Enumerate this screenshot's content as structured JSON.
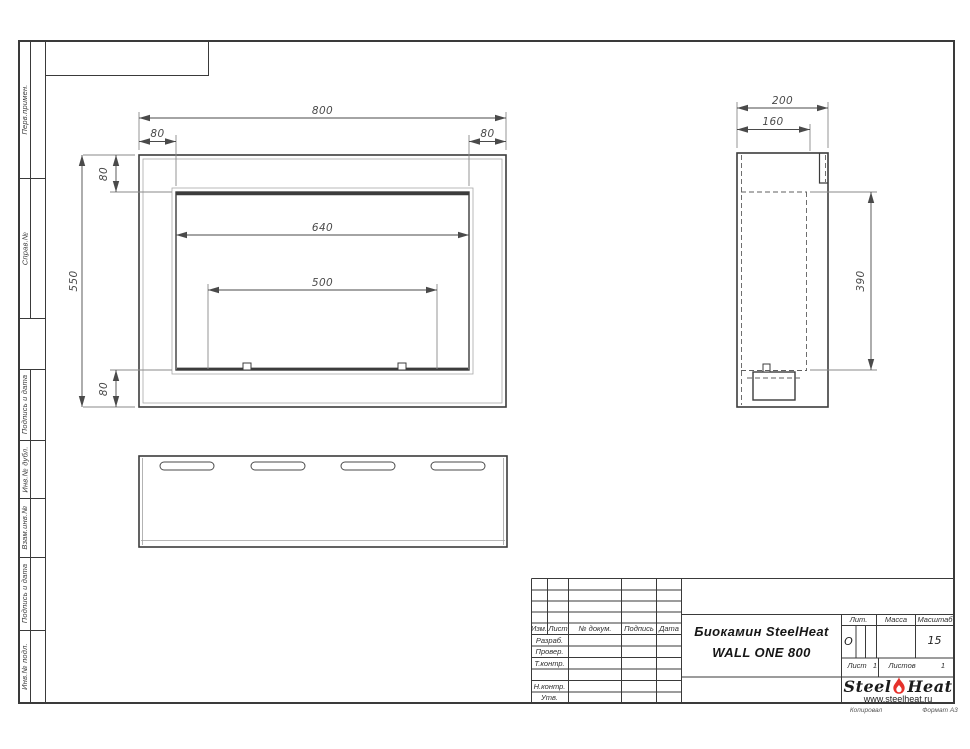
{
  "sheet": {
    "kopiroval_label": "Копировал",
    "format_label": "Формат А3"
  },
  "sidebar": {
    "labels": [
      "Перв.примен.",
      "Справ.№",
      "Подпись и дата",
      "Инв.№ дубл.",
      "Взам.инв.№",
      "Подпись и дата",
      "Инв.№ подл."
    ]
  },
  "drawing": {
    "dims": {
      "front": {
        "width": "800",
        "left": "80",
        "right": "80",
        "opening": "640",
        "burner": "500",
        "height": "550",
        "top": "80",
        "bottom": "80"
      },
      "side": {
        "depth": "200",
        "inner_depth": "160",
        "opening_height": "390"
      }
    }
  },
  "title_block": {
    "col_headers": [
      "Изм.",
      "Лист",
      "№ докум.",
      "Подпись",
      "Дата"
    ],
    "row_labels": [
      "Разраб.",
      "Провер.",
      "Т.контр.",
      "Н.контр.",
      "Утв."
    ],
    "title_line1": "Биокамин SteelHeat",
    "title_line2": "WALL ONE 800",
    "lit_label": "Лит.",
    "lit_value": "О",
    "mass_label": "Масса",
    "scale_label": "Масштаб",
    "scale_value": "15",
    "sheet_label": "Лист",
    "sheet_number": "1",
    "sheets_label": "Листов",
    "sheets_total": "1",
    "logo": {
      "word1": "Steel",
      "word2": "Heat",
      "website": "www.steelheat.ru",
      "flame_color": "#e5312b"
    }
  }
}
